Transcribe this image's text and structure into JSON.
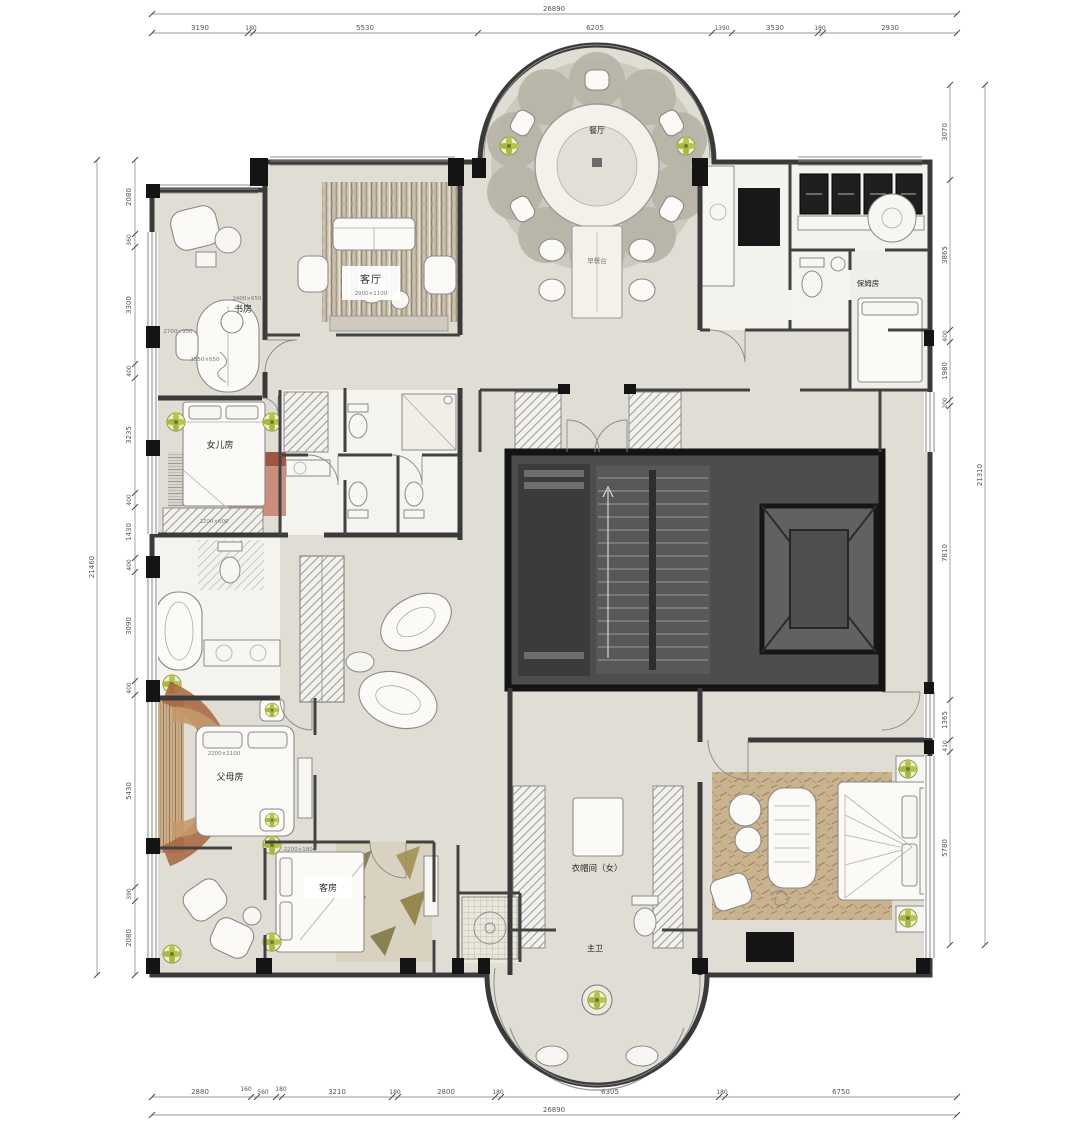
{
  "plan": {
    "rooms": {
      "dining": "餐厅",
      "breakfast": "早餐台",
      "living": "客厅",
      "study": "书房",
      "daughter": "女儿房",
      "parents": "父母房",
      "guest": "客房",
      "closet_female": "衣帽间（女）",
      "master_bath": "主卫",
      "nanny": "保姆房"
    },
    "furniture_labels": {
      "living_size": "2900×1100",
      "study_desk": "2400×650",
      "study_chaise": "2700×900",
      "study_sofa": "1550×650",
      "daughter_wardrobe": "2200×600",
      "parents_bed": "2200×2100",
      "guest_bed": "2200×1800"
    }
  },
  "dimensions": {
    "top_total": "26890",
    "top_segments": [
      "3190",
      "180",
      "5530",
      "6205",
      "1390",
      "3530",
      "180",
      "2930"
    ],
    "bottom_segments": [
      "2880",
      "160",
      "560",
      "180",
      "3210",
      "180",
      "2800",
      "180",
      "6305",
      "180",
      "6750"
    ],
    "bottom_total": "26890",
    "left_total": "21460",
    "left_segments": [
      "2080",
      "360",
      "3300",
      "400",
      "3235",
      "400",
      "1430",
      "400",
      "3090",
      "400",
      "5430",
      "390",
      "2080"
    ],
    "right_total": "21310",
    "right_segments": [
      "3070",
      "3865",
      "400",
      "1980",
      "200",
      "7810",
      "1365",
      "410",
      "5780"
    ]
  },
  "colors": {
    "floor": "#e0ddd5",
    "wall": "#3a3a3a",
    "core": "#4d4d4d",
    "accent_rust": "#a8643f",
    "accent_pink": "#c57f6f",
    "plant_green": "#b6c34d",
    "rug_tan": "#c9b28e"
  }
}
